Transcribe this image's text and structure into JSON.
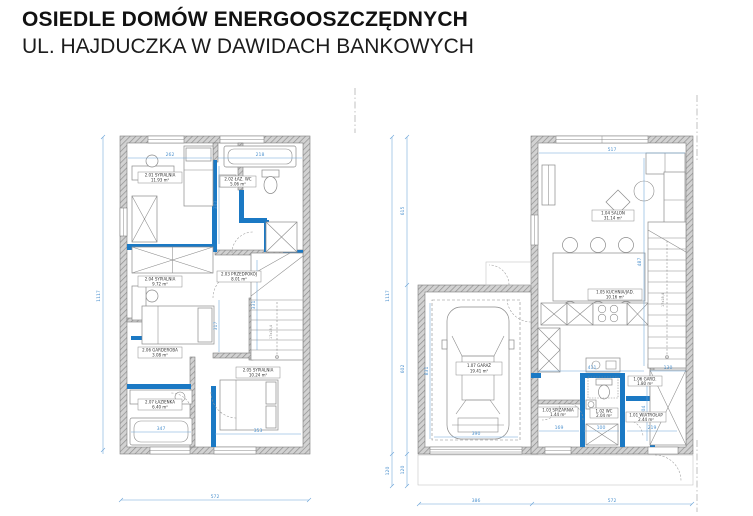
{
  "title": {
    "line1": "OSIEDLE DOMÓW ENERGOOSZCZĘDNYCH",
    "line2": "UL. HAJDUCZKA W DAWIDACH BANKOWYCH"
  },
  "colors": {
    "accent_wall_blue": "#1b79c4",
    "dimension_blue": "#6aa3d8",
    "wall_hatch_gray": "#d2d2d2",
    "line_gray": "#8a8a8a"
  },
  "floor_upper": {
    "rooms": [
      {
        "label": "2.01 SYPIALNIA",
        "area": "11.93 m²"
      },
      {
        "label": "2.02 ŁAZ. WC",
        "area": "5.06 m²"
      },
      {
        "label": "2.03 PRZEDPOKÓJ",
        "area": "8.01 m²"
      },
      {
        "label": "2.04 SYPIALNIA",
        "area": "9.72 m²"
      },
      {
        "label": "2.05 SYPIALNIA",
        "area": "10.24 m²"
      },
      {
        "label": "2.06 GARDEROBA",
        "area": "3.08 m²"
      },
      {
        "label": "2.07 ŁAZIENKA",
        "area": "6.40 m²"
      }
    ],
    "dims": {
      "total_height": "1117",
      "total_width": "572",
      "top_left": "262",
      "top_right": "218",
      "mid_upper": "343",
      "mid_lower": "317",
      "hall": "331",
      "bath_width": "347",
      "bed_width": "353"
    },
    "stairs_note": "17x18,4"
  },
  "floor_ground": {
    "rooms": [
      {
        "label": "1.01 WIATROŁAP",
        "area": "2.44 m²"
      },
      {
        "label": "1.02 WC",
        "area": "2.04 m²"
      },
      {
        "label": "1.03 SPIŻARNIA",
        "area": "1.44 m²"
      },
      {
        "label": "1.04 SALON",
        "area": "31.14 m²"
      },
      {
        "label": "1.05 KUCHNIA/JAD.",
        "area": "10.16 m²"
      },
      {
        "label": "1.06 GARD.",
        "area": "1.80 m²"
      },
      {
        "label": "1.07 GARAŻ",
        "area": "19.41 m²"
      }
    ],
    "dims": {
      "total_height": "1117",
      "height_top": "615",
      "height_garage": "602",
      "height_porch": "120",
      "height_porch2": "120",
      "width_garage": "386",
      "width_house": "572",
      "salon_width": "517",
      "stair_run": "487",
      "kitchen_width": "411",
      "stair_width": "130",
      "hall_height": "204",
      "dim_169": "169",
      "dim_100": "100",
      "dim_219": "219",
      "garage_height": "831",
      "garage_width": "390"
    },
    "stairs_note": "17x18,4"
  }
}
